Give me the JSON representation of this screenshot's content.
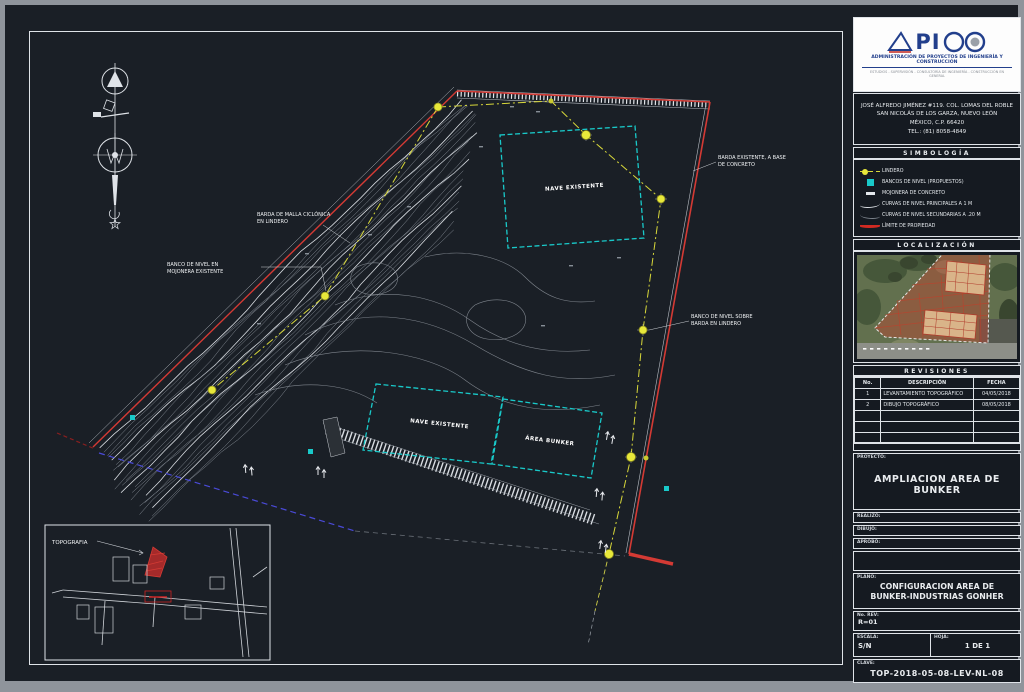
{
  "colors": {
    "boundary_red": "#d43a34",
    "lindero_yellow": "#d8d83a",
    "building_cyan": "#19c9c9",
    "bottom_blue": "#4a4ad8",
    "logo_blue": "#223f8c",
    "sheet_bg": "#1a1f26"
  },
  "titleblock": {
    "logo": {
      "name": "APICO",
      "letters": "PI",
      "tagline": "ADMINISTRACIÓN DE PROYECTOS DE INGENIERÍA Y CONSTRUCCIÓN",
      "subtagline": "ESTUDIOS - SUPERVISIÓN - CONSULTORÍA DE INGENIERÍA - CONSTRUCCIÓN EN GENERAL"
    },
    "address_lines": {
      "l1": "JOSÉ ALFREDO JIMÉNEZ #119. COL. LOMAS DEL ROBLE",
      "l2": "SAN NICOLÁS DE LOS GARZA, NUEVO LEÓN",
      "l3": "MÉXICO, C.P. 66420",
      "l4": "TEL.: (81) 8058-4849"
    },
    "simbologia": {
      "header": "SIMBOLOGÍA",
      "items": [
        {
          "icon": "lindero-icon",
          "label": "LINDERO"
        },
        {
          "icon": "banco-nivel-icon",
          "label": "BANCOS DE NIVEL (PROPUESTOS)"
        },
        {
          "icon": "mojonera-icon",
          "label": "MOJONERA DE CONCRETO"
        },
        {
          "icon": "curva-mayor-icon",
          "label": "CURVAS DE NIVEL PRINCIPALES A 1 M"
        },
        {
          "icon": "curva-menor-icon",
          "label": "CURVAS DE NIVEL SECUNDARIAS A .20 M"
        },
        {
          "icon": "limite-propiedad-icon",
          "label": "LÍMITE DE PROPIEDAD"
        }
      ]
    },
    "localizacion": {
      "header": "LOCALIZACIÓN"
    },
    "revisiones": {
      "header": "REVISIONES",
      "columns": {
        "no": "No.",
        "desc": "DESCRIPCIÓN",
        "fecha": "FECHA"
      },
      "rows": [
        {
          "no": "1",
          "desc": "LEVANTAMIENTO TOPOGRÁFICO",
          "fecha": "04/05/2018"
        },
        {
          "no": "2",
          "desc": "DIBUJO TOPOGRÁFICO",
          "fecha": "08/05/2018"
        },
        {
          "no": "",
          "desc": "",
          "fecha": ""
        },
        {
          "no": "",
          "desc": "",
          "fecha": ""
        },
        {
          "no": "",
          "desc": "",
          "fecha": ""
        }
      ]
    },
    "proyecto": {
      "label": "PROYECTO:",
      "title": "AMPLIACION AREA DE BUNKER"
    },
    "fields": {
      "f1": "REALIZÓ:",
      "f2": "DIBUJÓ:",
      "f3": "APROBÓ:"
    },
    "plano": {
      "label": "PLANO:",
      "title": "CONFIGURACION AREA DE BUNKER-INDUSTRIAS GONHER"
    },
    "rev": {
      "label": "No. REV:",
      "value": "R=01"
    },
    "escala": {
      "label": "ESCALA:",
      "value": "S/N"
    },
    "hoja": {
      "label": "HOJA:",
      "value": "1 DE 1"
    },
    "clave": {
      "label": "CLAVE:",
      "value": "TOP-2018-05-08-LEV-NL-08"
    }
  },
  "drawing": {
    "buildings": [
      {
        "label": "NAVE EXISTENTE"
      },
      {
        "label": "NAVE EXISTENTE"
      },
      {
        "label": "ÁREA BUNKER"
      }
    ],
    "callouts": [
      {
        "l1": "BARDA EXISTENTE, A BASE",
        "l2": "DE CONCRETO"
      },
      {
        "l1": "BARDA DE MALLA CICLÓNICA",
        "l2": "EN LINDERO"
      },
      {
        "l1": "BANCO DE NIVEL EN",
        "l2": "MOJONERA EXISTENTE"
      },
      {
        "l1": "BANCO DE NIVEL SOBRE",
        "l2": "BARDA EN LINDERO"
      }
    ],
    "inset": {
      "label": "TOPOGRAFIA"
    }
  }
}
